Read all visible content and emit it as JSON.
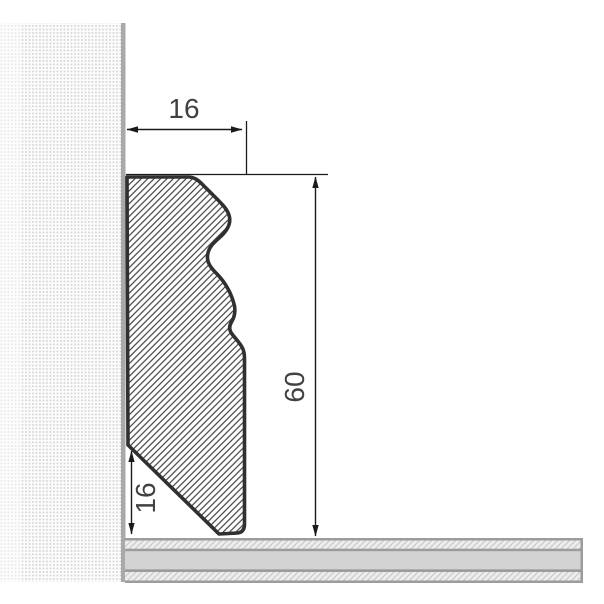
{
  "diagram": {
    "labels": {
      "width_mm": "16",
      "height_mm": "60",
      "bottom_bevel_mm": "16"
    },
    "colors": {
      "profile_outline": "#303030",
      "profile_hatch": "#3f3f3f",
      "wall_edge": "#a9a9a9",
      "wall_dot": "#d4d4d4",
      "floor_border": "#9c9c9c",
      "floor_band": "#d3d3d3",
      "floor_hatch_bg": "#ededed",
      "floor_hatch_line": "#c6c6c6",
      "dimension_line": "#1a1a1a",
      "label_text": "#414141"
    }
  }
}
